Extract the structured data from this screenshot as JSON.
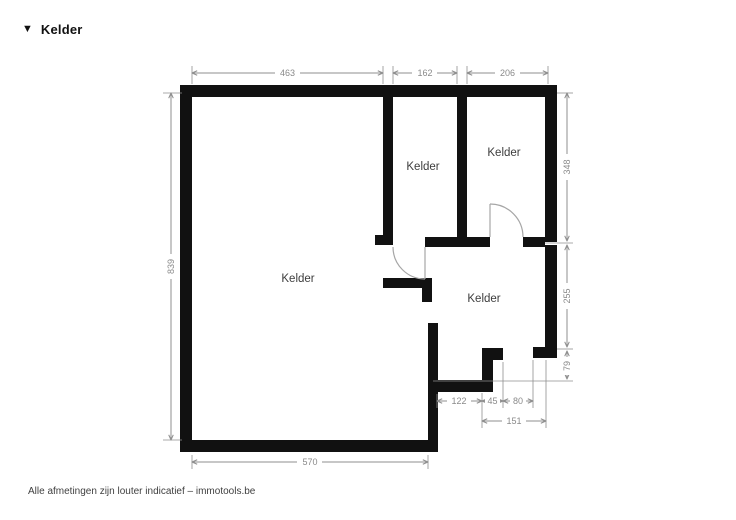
{
  "header": {
    "marker_glyph": "▼",
    "title": "Kelder"
  },
  "floorplan": {
    "rooms": [
      {
        "name": "room-large",
        "label": "Kelder"
      },
      {
        "name": "room-middle",
        "label": "Kelder"
      },
      {
        "name": "room-upper-right",
        "label": "Kelder"
      },
      {
        "name": "room-lower-right",
        "label": "Kelder"
      }
    ],
    "dimensions": {
      "top": [
        {
          "value": "463"
        },
        {
          "value": "162"
        },
        {
          "value": "206"
        }
      ],
      "left": {
        "value": "839"
      },
      "right": [
        {
          "value": "348"
        },
        {
          "value": "255"
        },
        {
          "value": "79"
        }
      ],
      "bottom_detail": [
        {
          "value": "122"
        },
        {
          "value": "45"
        },
        {
          "value": "80"
        }
      ],
      "bottom_span": {
        "value": "151"
      },
      "bottom": {
        "value": "570"
      }
    },
    "colors": {
      "wall": "#111111",
      "dimension": "#8f8f8f",
      "room_label": "#3d3d3d",
      "door": "#a6a6a6"
    }
  },
  "footer": {
    "text": "Alle afmetingen zijn louter indicatief – immotools.be"
  }
}
